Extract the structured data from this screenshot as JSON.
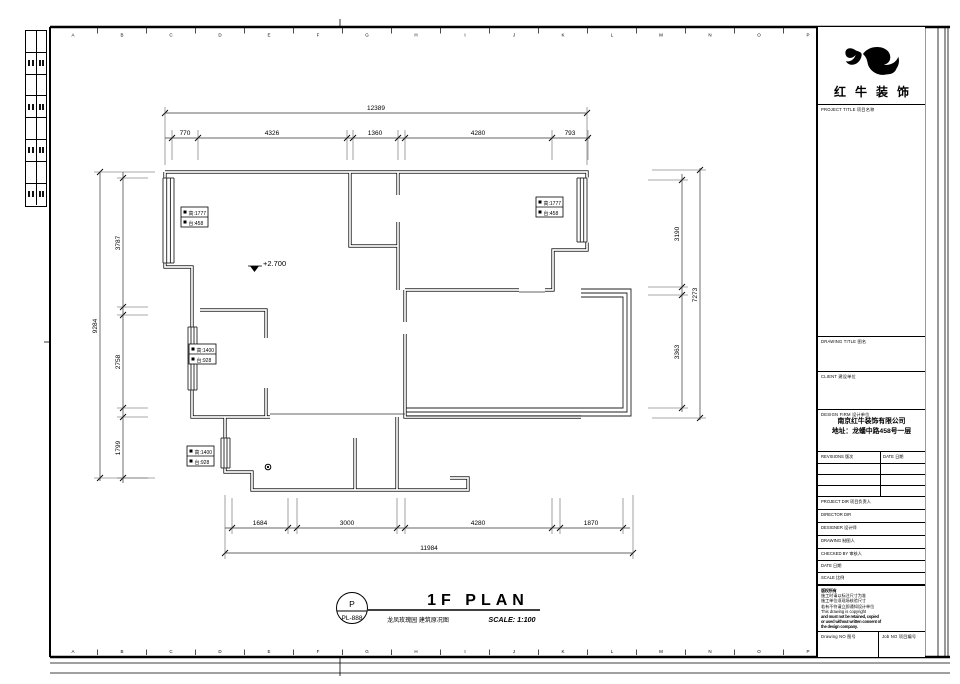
{
  "frame": {
    "letters": [
      "A",
      "B",
      "C",
      "D",
      "E",
      "F",
      "G",
      "H",
      "I",
      "J",
      "K",
      "L",
      "M",
      "N",
      "O",
      "P"
    ],
    "edge_strip_rows": 8
  },
  "dimensions": {
    "top": {
      "total": "12389",
      "segments": [
        "770",
        "4326",
        "1360",
        "4280",
        "793"
      ]
    },
    "left": {
      "total": "9284",
      "segments": [
        "3787",
        "2758",
        "1799"
      ]
    },
    "right": {
      "total": "7273",
      "segments": [
        "3190",
        "3363"
      ]
    },
    "bottom": {
      "total": "11984",
      "segments": [
        "1684",
        "3000",
        "4280",
        "1870"
      ]
    }
  },
  "plan": {
    "elevation": "+2.700",
    "window_labels": [
      {
        "l1": "高:1777",
        "l2": "台:458"
      },
      {
        "l1": "高:1777",
        "l2": "台:458"
      },
      {
        "l1": "高:1400",
        "l2": "台:928"
      },
      {
        "l1": "高:1400",
        "l2": "台:928"
      }
    ]
  },
  "footer": {
    "stamp_top": "P",
    "stamp_no": "PL-888",
    "plan_title": "1F PLAN",
    "subtitle": "龙凤玫瑰园 建筑原况图",
    "scale": "SCALE: 1:100"
  },
  "titleblock": {
    "brand": "红牛装饰",
    "project_title_label": "PROJECT TITLE 项目名称",
    "drawing_title_label": "DRAWING TITLE 图名",
    "client_label": "CLIENT 建设单位",
    "design_firm_label": "DESIGN FIRM 设计单位",
    "firm_name": "南京红牛装饰有限公司",
    "firm_address": "地址：龙蟠中路458号一层",
    "revisions_label": "REVISIONS 版次",
    "rev_date_label": "DATE 日期",
    "project_dir_label": "PROJECT DIR   项目负责人",
    "director_label": "DIRECTOR DIR",
    "designer_label": "DESIGNER   设计师",
    "drawing_by_label": "DRAWING   制图人",
    "checked_by_label": "CHECKED BY   审核人",
    "date_label": "DATE   日期",
    "scale_label": "SCALE   比例",
    "notes": [
      "版权所有",
      "施工时请以标注尺寸为准",
      "施工单位须现场核验尺寸",
      "若有不符请立即通知设计单位",
      "This drawing is copyright",
      "and must not be retained, copied",
      "or used without written consent of",
      "the design company."
    ],
    "drawing_no_label": "Drawing NO 图号",
    "job_no_label": "Job NO 项目编号"
  }
}
